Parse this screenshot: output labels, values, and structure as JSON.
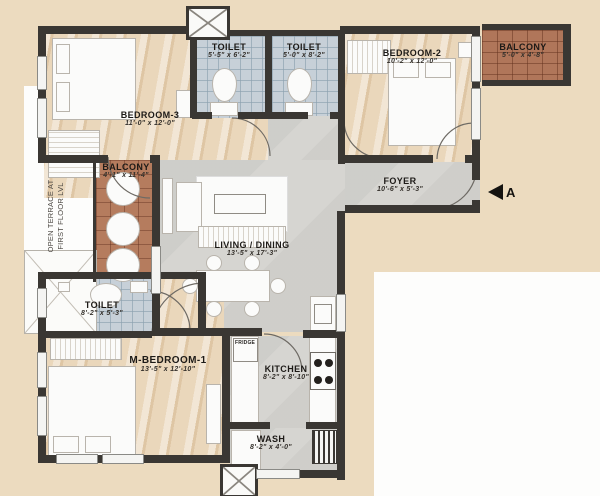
{
  "rooms": {
    "bedroom3": {
      "name": "BEDROOM-3",
      "dims": "11'-0\" x 12'-0\""
    },
    "toilet_top_left": {
      "name": "TOILET",
      "dims": "5'-5\" x 6'-2\""
    },
    "toilet_top_right": {
      "name": "TOILET",
      "dims": "5'-0\" x 8'-2\""
    },
    "bedroom2": {
      "name": "BEDROOM-2",
      "dims": "10'-2\" x 12'-0\""
    },
    "balcony_right": {
      "name": "BALCONY",
      "dims": "5'-0\" x 4'-8\""
    },
    "balcony_left": {
      "name": "BALCONY",
      "dims": "4'-1\" x 11'-4\""
    },
    "foyer": {
      "name": "FOYER",
      "dims": "10'-6\" x 5'-3\""
    },
    "living_dining": {
      "name": "LIVING / DINING",
      "dims": "13'-5\" x 17'-3\""
    },
    "toilet_master": {
      "name": "TOILET",
      "dims": "8'-2\" x 5'-3\""
    },
    "master_bedroom": {
      "name": "M-BEDROOM-1",
      "dims": "13'-5\" x 12'-10\""
    },
    "kitchen": {
      "name": "KITCHEN",
      "dims": "8'-2\" x 8'-10\""
    },
    "wash": {
      "name": "WASH",
      "dims": "8'-2\" x 4'-0\""
    }
  },
  "annotations": {
    "open_terrace_line1": "OPEN TERRACE AT",
    "open_terrace_line2": "FIRST FLOOR LVL",
    "fridge": "FRIDGE",
    "section_marker": "A"
  },
  "colors": {
    "background": "#ecdbbf",
    "wall": "#3a3733",
    "wood_floor": "#ead7bb",
    "tile_floor": "#c7d0d8",
    "brick_floor": "#b0765a",
    "concrete_floor": "#d6d5d1",
    "label_text": "#1d1a17"
  }
}
